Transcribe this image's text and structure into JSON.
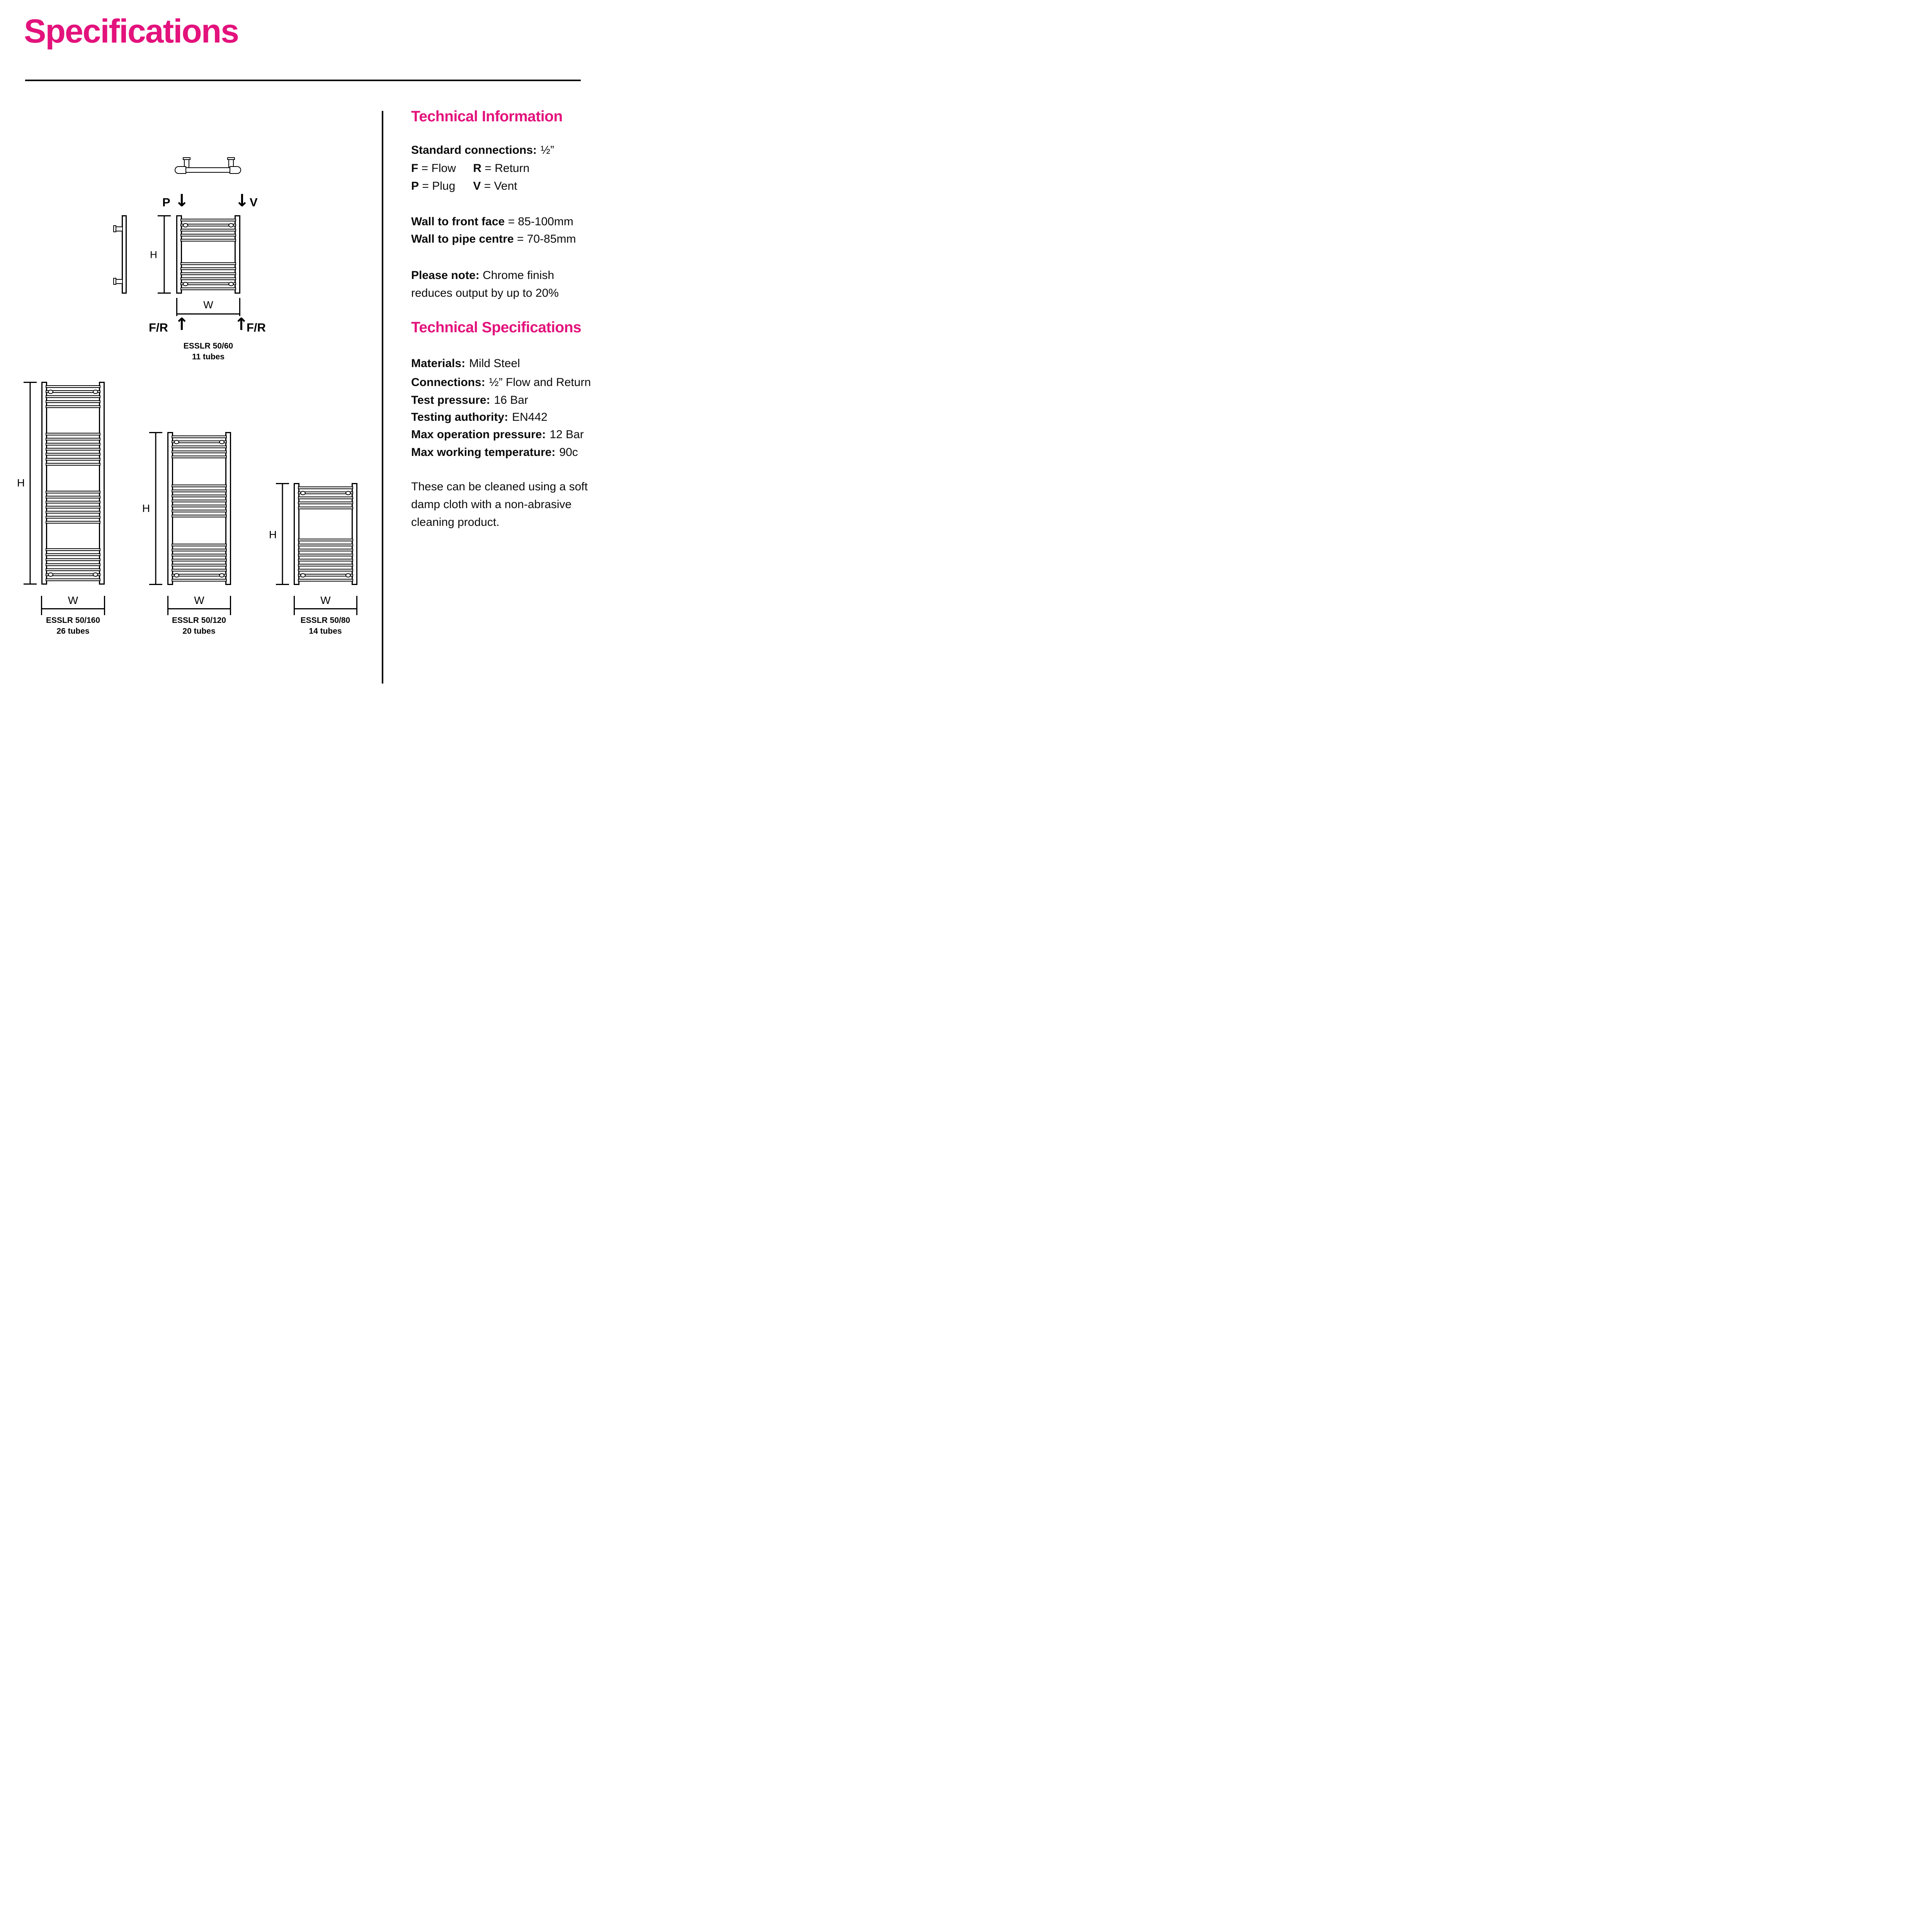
{
  "page": {
    "title": "Specifications"
  },
  "colors": {
    "accent_pink": "#E3127C",
    "line_black": "#000000"
  },
  "icons": {
    "down_arrow": "↓",
    "up_arrow": "↑"
  },
  "right_column": {
    "technical_information": {
      "heading": "Technical Information",
      "standard_connections_label": "Standard connections:",
      "standard_connections_value": "½”",
      "legend": [
        {
          "key": "F",
          "rest": "= Flow"
        },
        {
          "key": "R",
          "rest": "= Return"
        },
        {
          "key": "P",
          "rest": "= Plug"
        },
        {
          "key": "V",
          "rest": "= Vent"
        }
      ],
      "wall_to_front_face_label": "Wall to front face",
      "wall_to_front_face_value": "= 85-100mm",
      "wall_to_pipe_centre_label": "Wall to pipe centre",
      "wall_to_pipe_centre_value": "= 70-85mm",
      "note_label": "Please note:",
      "note_line1": "Chrome finish",
      "note_line2": "reduces output by up to 20%"
    },
    "technical_specifications": {
      "heading": "Technical Specifications",
      "specs": [
        {
          "label": "Materials:",
          "value": "Mild Steel"
        },
        {
          "label": "Connections:",
          "value": "½” Flow and Return"
        },
        {
          "label": "Test pressure:",
          "value": "16 Bar"
        },
        {
          "label": "Testing authority:",
          "value": "EN442"
        },
        {
          "label": "Max operation pressure:",
          "value": "12 Bar"
        },
        {
          "label": "Max working temperature:",
          "value": "90c"
        }
      ],
      "cleaning_note_lines": [
        "These can be cleaned using a soft",
        "damp cloth with a non-abrasive",
        "cleaning product."
      ]
    }
  },
  "diagrams": {
    "dim_labels": {
      "height": "H",
      "width": "W"
    },
    "connection_labels": {
      "plug": "P",
      "vent": "V",
      "flow_return": "F/R"
    },
    "radiators": [
      {
        "model": "ESSLR 50/60",
        "tubes_label": "11 tubes",
        "tube_count": 11,
        "clusters": [
          5,
          6
        ],
        "vents": [
          {
            "cluster": 0,
            "rung": 1
          },
          {
            "cluster": 1,
            "rung": 4
          }
        ]
      },
      {
        "model": "ESSLR 50/160",
        "tubes_label": "26 tubes",
        "tube_count": 26,
        "clusters": [
          5,
          7,
          7,
          7
        ],
        "vents": [
          {
            "cluster": 0,
            "rung": 1
          },
          {
            "cluster": 3,
            "rung": 5
          }
        ]
      },
      {
        "model": "ESSLR 50/120",
        "tubes_label": "20 tubes",
        "tube_count": 20,
        "clusters": [
          5,
          7,
          8
        ],
        "vents": [
          {
            "cluster": 0,
            "rung": 1
          },
          {
            "cluster": 2,
            "rung": 6
          }
        ]
      },
      {
        "model": "ESSLR 50/80",
        "tubes_label": "14 tubes",
        "tube_count": 14,
        "clusters": [
          5,
          9
        ],
        "vents": [
          {
            "cluster": 0,
            "rung": 1
          },
          {
            "cluster": 1,
            "rung": 7
          }
        ]
      }
    ]
  }
}
